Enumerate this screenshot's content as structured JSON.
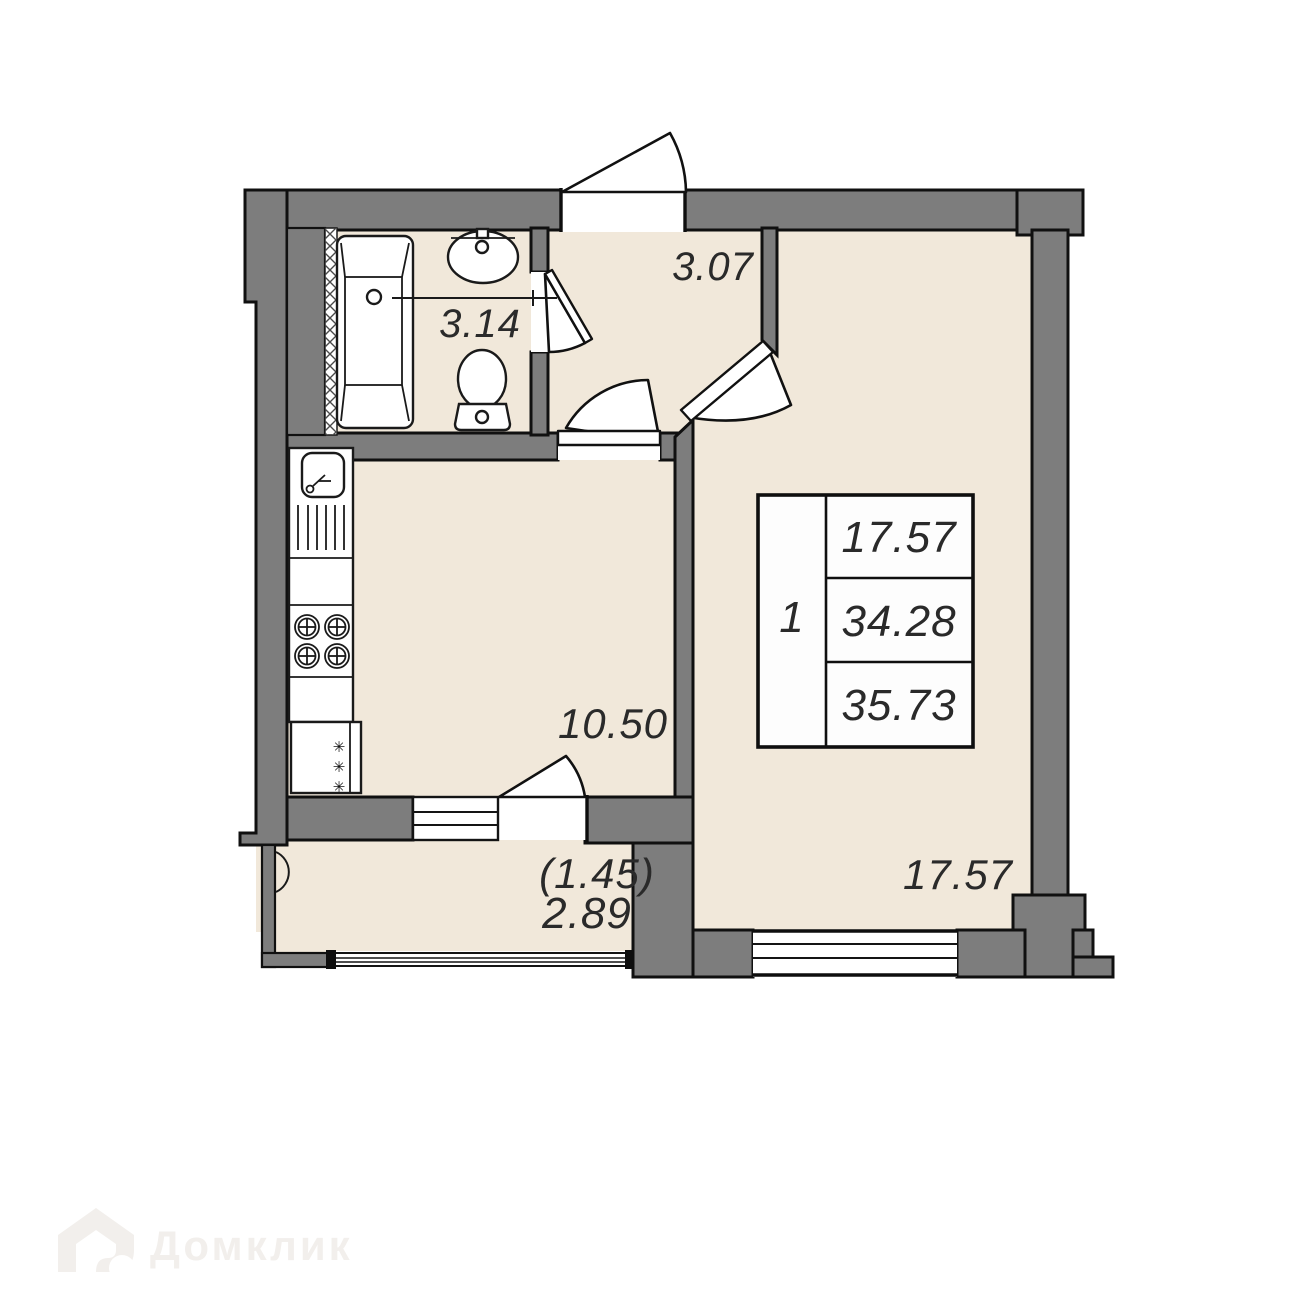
{
  "plan": {
    "title": "1-room apartment floor plan",
    "rooms": {
      "bathroom": {
        "name": "bathroom",
        "area": "3.14"
      },
      "hallway": {
        "name": "hallway",
        "area": "3.07"
      },
      "kitchen": {
        "name": "kitchen",
        "area": "10.50"
      },
      "living_room": {
        "name": "living room",
        "area": "17.57"
      },
      "balcony": {
        "name": "balcony",
        "area_with_coefficient": "(1.45)",
        "area": "2.89"
      }
    },
    "info_table": {
      "rooms_count": "1",
      "living_area": "17.57",
      "area_without_balcony": "34.28",
      "total_area": "35.73"
    },
    "icons": {
      "snowflake": "✳"
    },
    "watermark": {
      "brand": "Домклик"
    },
    "colors": {
      "floor": "#f1e8da",
      "wall": "#7d7d7d",
      "outline": "#101010",
      "fixture_white": "#ffffff",
      "label_text": "#2a2a2a",
      "watermark": "#f2efec"
    }
  }
}
